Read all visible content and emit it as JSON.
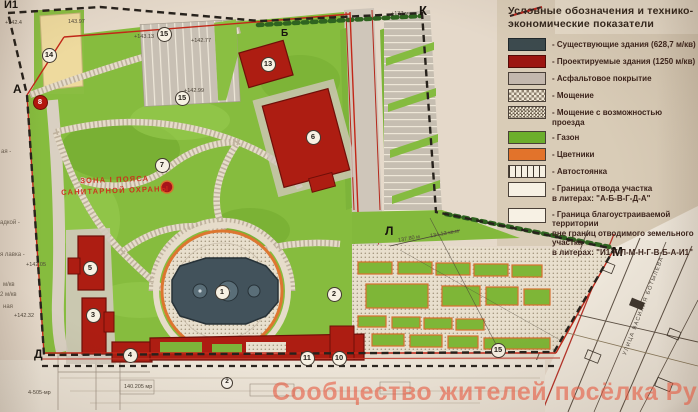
{
  "legend": {
    "title_line1": "Условные обозначения и технико-",
    "title_line2": "экономические показатели",
    "items": [
      {
        "label": "- Существующие здания (628,7 м/кв)"
      },
      {
        "label": "- Проектируемые здания (1250 м/кв)"
      },
      {
        "label": "- Асфальтовое покрытие"
      },
      {
        "label": "- Мощение"
      },
      {
        "label": "- Мощение с возможностью проезда"
      },
      {
        "label": "- Газон"
      },
      {
        "label": "- Цветники"
      },
      {
        "label": "- Автостоянка"
      },
      {
        "line1": "- Граница отвода участка",
        "line2": "в литерах: \"А-Б-В-Г-Д-А\""
      },
      {
        "line1": "- Граница благоустраиваемой территории",
        "line2": "вне границ отводимого земельного участка",
        "line3": "в литерах: \"И1-К-Л-М-Н-Г-В-Б-А-И1\""
      }
    ]
  },
  "map": {
    "markers": [
      {
        "label": "1"
      },
      {
        "label": "2"
      },
      {
        "label": "3"
      },
      {
        "label": "4"
      },
      {
        "label": "5"
      },
      {
        "label": "6"
      },
      {
        "label": "7"
      },
      {
        "label": "8"
      },
      {
        "label": "10"
      },
      {
        "label": "11"
      },
      {
        "label": "13"
      },
      {
        "label": "14"
      },
      {
        "label": "15"
      },
      {
        "label": "15"
      },
      {
        "label": "15"
      },
      {
        "label": "2"
      }
    ],
    "letters": [
      {
        "label": "И1"
      },
      {
        "label": "А"
      },
      {
        "label": "Б"
      },
      {
        "label": "К"
      },
      {
        "label": "Л"
      },
      {
        "label": "М"
      },
      {
        "label": "Д"
      }
    ],
    "sanitary_zone": {
      "line1": "ЗОНА I ПОЯСА",
      "line2": "САНИТАРНОЙ ОХРАНЫ"
    },
    "street_name": "УЛИЦА ВАСИЛИЯ БОТЫЛЕВА",
    "elevations": [
      {
        "text": "+142.4"
      },
      {
        "text": "143.97"
      },
      {
        "text": "+143.13"
      },
      {
        "text": "+142.77"
      },
      {
        "text": "+142.99"
      },
      {
        "text": "+137 м"
      },
      {
        "text": "+142.05"
      },
      {
        "text": "+142.32"
      },
      {
        "text": "137.80 м"
      },
      {
        "text": "134.13 кв.м"
      },
      {
        "text": "140.205 мр"
      },
      {
        "text": "4-505-мр"
      }
    ],
    "margin_fragments": [
      {
        "text": "ая -"
      },
      {
        "text": "адкой -"
      },
      {
        "text": "я лавка -"
      },
      {
        "text": "м/кв"
      },
      {
        "text": "2 м/кв"
      },
      {
        "text": "ная"
      }
    ]
  },
  "watermark": {
    "text": "Сообщество жителей посёлка Рублёво"
  },
  "colors": {
    "paper": "#e5d9ca",
    "legend_paper": "#d9ccb7",
    "lawn": "#84ba3c",
    "existing_building": "#3c4a4e",
    "proposed_building": "#9c1511",
    "flowers": "#e2732b",
    "boundary_red": "#c0281c",
    "boundary_dash": "#27221c"
  }
}
